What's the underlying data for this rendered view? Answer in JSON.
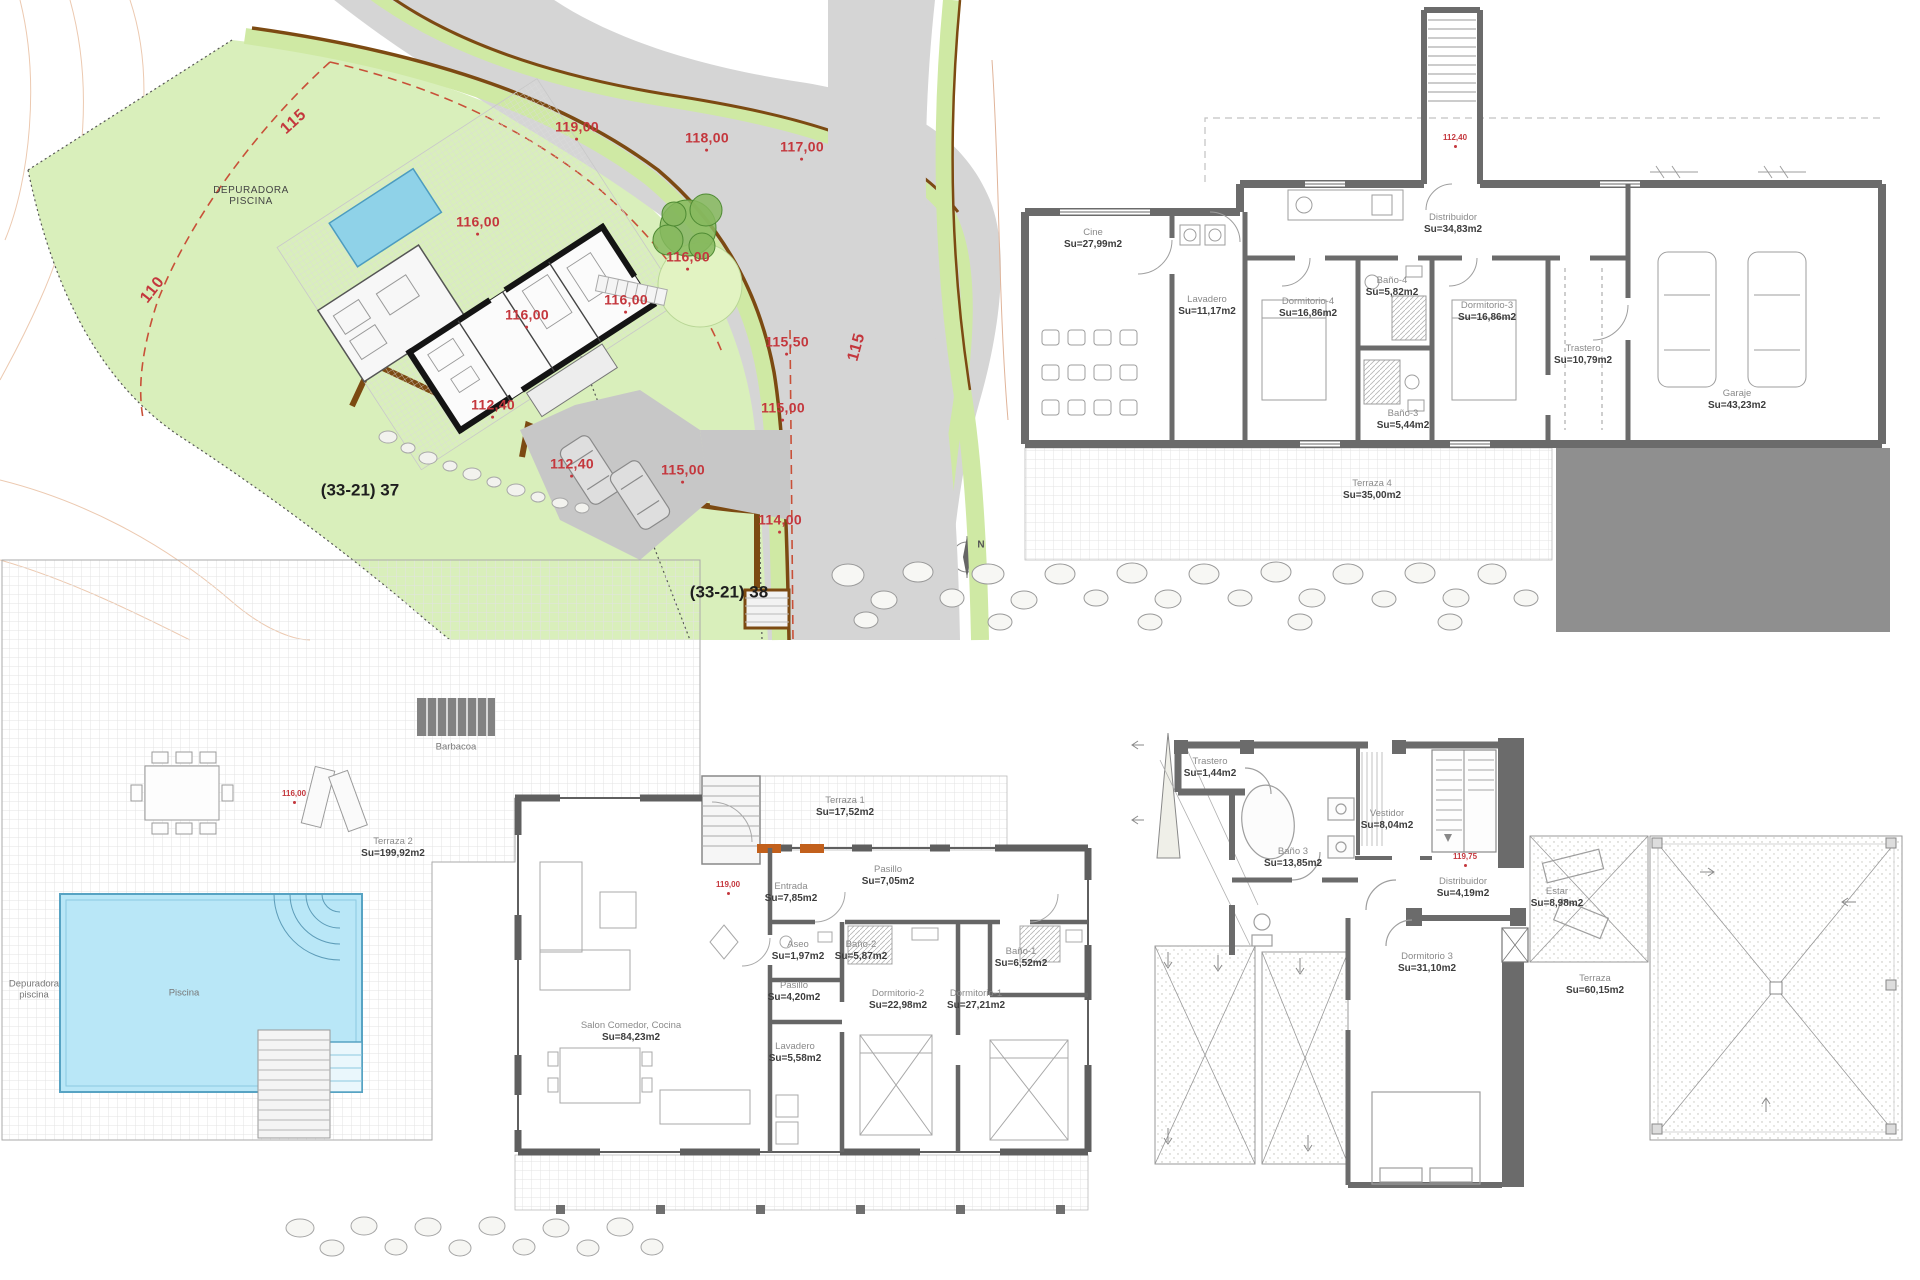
{
  "colors": {
    "elevation_red": "#c4373d",
    "plot_green": "#d9efbb",
    "road_gray": "#d5d5d5",
    "curb_brown": "#7c4a12",
    "wall_gray": "#6b6b6b",
    "pool_blue": "#b9e7f7",
    "dark_block_gray": "#8f8f8f",
    "door_orange": "#c2601c"
  },
  "plans": {
    "site_plan": {
      "labels": [
        {
          "n": "setback-label-115",
          "t": [
            "115"
          ],
          "x": 294,
          "y": 122,
          "c": "red-md",
          "r": -42
        },
        {
          "n": "setback-label-110",
          "t": [
            "110"
          ],
          "x": 153,
          "y": 290,
          "c": "red-md",
          "r": -52
        },
        {
          "n": "road-label-115",
          "t": [
            "115"
          ],
          "x": 857,
          "y": 347,
          "c": "red-md",
          "r": -75
        },
        {
          "n": "elevation",
          "t": [
            "119,00"
          ],
          "x": 577,
          "y": 130,
          "c": "red-lg",
          "d": true
        },
        {
          "n": "elevation",
          "t": [
            "118,00"
          ],
          "x": 707,
          "y": 141,
          "c": "red-lg",
          "d": true
        },
        {
          "n": "elevation",
          "t": [
            "117,00"
          ],
          "x": 802,
          "y": 150,
          "c": "red-lg",
          "d": true
        },
        {
          "n": "elevation",
          "t": [
            "116,00"
          ],
          "x": 478,
          "y": 225,
          "c": "red-lg",
          "d": true
        },
        {
          "n": "elevation",
          "t": [
            "116,00"
          ],
          "x": 527,
          "y": 318,
          "c": "red-lg",
          "d": true
        },
        {
          "n": "elevation",
          "t": [
            "116,00"
          ],
          "x": 626,
          "y": 303,
          "c": "red-lg",
          "d": true
        },
        {
          "n": "elevation",
          "t": [
            "116,00"
          ],
          "x": 688,
          "y": 260,
          "c": "red-lg",
          "d": true
        },
        {
          "n": "elevation",
          "t": [
            "115,50"
          ],
          "x": 787,
          "y": 345,
          "c": "red-lg",
          "d": true
        },
        {
          "n": "elevation",
          "t": [
            "115,00"
          ],
          "x": 783,
          "y": 411,
          "c": "red-lg",
          "d": true
        },
        {
          "n": "elevation",
          "t": [
            "115,00"
          ],
          "x": 683,
          "y": 473,
          "c": "red-lg",
          "d": true
        },
        {
          "n": "elevation",
          "t": [
            "112,40"
          ],
          "x": 493,
          "y": 408,
          "c": "red-lg",
          "d": true
        },
        {
          "n": "elevation",
          "t": [
            "112,40"
          ],
          "x": 572,
          "y": 467,
          "c": "red-lg",
          "d": true
        },
        {
          "n": "elevation",
          "t": [
            "114,00"
          ],
          "x": 780,
          "y": 523,
          "c": "red-lg",
          "d": true
        },
        {
          "n": "depuradora-piscina-label",
          "t": [
            "DEPURADORA",
            "PISCINA"
          ],
          "x": 251,
          "y": 196,
          "c": "site-name"
        },
        {
          "n": "parcel-label",
          "t": [
            "(33-21) 37"
          ],
          "x": 360,
          "y": 490,
          "c": "blk"
        },
        {
          "n": "parcel-label",
          "t": [
            "(33-21) 38"
          ],
          "x": 729,
          "y": 592,
          "c": "blk"
        },
        {
          "n": "north-label",
          "t": [
            "N"
          ],
          "x": 981,
          "y": 545,
          "c": "north"
        }
      ]
    },
    "basement_plan": {
      "labels": [
        {
          "n": "room-label",
          "t": [
            "Cine",
            "Su=27,99m2"
          ],
          "x": 1093,
          "y": 239,
          "c": "room"
        },
        {
          "n": "room-label",
          "t": [
            "Lavadero",
            "Su=11,17m2"
          ],
          "x": 1207,
          "y": 306,
          "c": "room"
        },
        {
          "n": "room-label",
          "t": [
            "Dormitorio-4",
            "Su=16,86m2"
          ],
          "x": 1308,
          "y": 308,
          "c": "room"
        },
        {
          "n": "room-label",
          "t": [
            "Baño-4",
            "Su=5,82m2"
          ],
          "x": 1392,
          "y": 287,
          "c": "room"
        },
        {
          "n": "room-label",
          "t": [
            "Dormitorio-3",
            "Su=16,86m2"
          ],
          "x": 1487,
          "y": 312,
          "c": "room"
        },
        {
          "n": "room-label",
          "t": [
            "Trastero",
            "Su=10,79m2"
          ],
          "x": 1583,
          "y": 355,
          "c": "room"
        },
        {
          "n": "room-label",
          "t": [
            "Baño-3",
            "Su=5,44m2"
          ],
          "x": 1403,
          "y": 420,
          "c": "room"
        },
        {
          "n": "room-label",
          "t": [
            "Garaje",
            "Su=43,23m2"
          ],
          "x": 1737,
          "y": 400,
          "c": "room"
        },
        {
          "n": "room-label",
          "t": [
            "Distribuidor",
            "Su=34,83m2"
          ],
          "x": 1453,
          "y": 224,
          "c": "room"
        },
        {
          "n": "room-label",
          "t": [
            "Terraza 4",
            "Su=35,00m2"
          ],
          "x": 1372,
          "y": 490,
          "c": "room"
        },
        {
          "n": "elevation",
          "t": [
            "112,40"
          ],
          "x": 1455,
          "y": 141,
          "c": "red-sm",
          "d": true
        }
      ]
    },
    "main_floor_plan": {
      "labels": [
        {
          "n": "room-label",
          "t": [
            "Terraza 2",
            "Su=199,92m2"
          ],
          "x": 393,
          "y": 848,
          "c": "room"
        },
        {
          "n": "room-label",
          "t": [
            "Barbacoa"
          ],
          "x": 456,
          "y": 748,
          "c": "room-plain"
        },
        {
          "n": "room-label",
          "t": [
            "Piscina"
          ],
          "x": 184,
          "y": 994,
          "c": "room-plain"
        },
        {
          "n": "room-label",
          "t": [
            "Depuradora",
            "piscina"
          ],
          "x": 34,
          "y": 990,
          "c": "room-plain"
        },
        {
          "n": "room-label",
          "t": [
            "Salon Comedor, Cocina",
            "Su=84,23m2"
          ],
          "x": 631,
          "y": 1032,
          "c": "room"
        },
        {
          "n": "room-label",
          "t": [
            "Entrada",
            "Su=7,85m2"
          ],
          "x": 791,
          "y": 893,
          "c": "room"
        },
        {
          "n": "room-label",
          "t": [
            "Terraza 1",
            "Su=17,52m2"
          ],
          "x": 845,
          "y": 807,
          "c": "room"
        },
        {
          "n": "room-label",
          "t": [
            "Pasillo",
            "Su=7,05m2"
          ],
          "x": 888,
          "y": 876,
          "c": "room"
        },
        {
          "n": "room-label",
          "t": [
            "Aseo",
            "Su=1,97m2"
          ],
          "x": 798,
          "y": 951,
          "c": "room"
        },
        {
          "n": "room-label",
          "t": [
            "Baño-2",
            "Su=5,87m2"
          ],
          "x": 861,
          "y": 951,
          "c": "room"
        },
        {
          "n": "room-label",
          "t": [
            "Pasillo",
            "Su=4,20m2"
          ],
          "x": 794,
          "y": 992,
          "c": "room"
        },
        {
          "n": "room-label",
          "t": [
            "Dormitorio-2",
            "Su=22,98m2"
          ],
          "x": 898,
          "y": 1000,
          "c": "room"
        },
        {
          "n": "room-label",
          "t": [
            "Dormitorio-1",
            "Su=27,21m2"
          ],
          "x": 976,
          "y": 1000,
          "c": "room"
        },
        {
          "n": "room-label",
          "t": [
            "Baño-1",
            "Su=6,52m2"
          ],
          "x": 1021,
          "y": 958,
          "c": "room"
        },
        {
          "n": "room-label",
          "t": [
            "Lavadero",
            "Su=5,58m2"
          ],
          "x": 795,
          "y": 1053,
          "c": "room"
        },
        {
          "n": "elevation",
          "t": [
            "116,00"
          ],
          "x": 294,
          "y": 797,
          "c": "red-sm",
          "d": true
        },
        {
          "n": "elevation",
          "t": [
            "119,00"
          ],
          "x": 728,
          "y": 888,
          "c": "red-sm",
          "d": true
        }
      ]
    },
    "upper_floor_plan": {
      "labels": [
        {
          "n": "room-label",
          "t": [
            "Trastero",
            "Su=1,44m2"
          ],
          "x": 1210,
          "y": 768,
          "c": "room"
        },
        {
          "n": "room-label",
          "t": [
            "Vestidor",
            "Su=8,04m2"
          ],
          "x": 1387,
          "y": 820,
          "c": "room"
        },
        {
          "n": "room-label",
          "t": [
            "Baño 3",
            "Su=13,85m2"
          ],
          "x": 1293,
          "y": 858,
          "c": "room"
        },
        {
          "n": "room-label",
          "t": [
            "Distribuidor",
            "Su=4,19m2"
          ],
          "x": 1463,
          "y": 888,
          "c": "room"
        },
        {
          "n": "room-label",
          "t": [
            "Estar",
            "Su=8,98m2"
          ],
          "x": 1557,
          "y": 898,
          "c": "room"
        },
        {
          "n": "room-label",
          "t": [
            "Dormitorio 3",
            "Su=31,10m2"
          ],
          "x": 1427,
          "y": 963,
          "c": "room"
        },
        {
          "n": "room-label",
          "t": [
            "Terraza",
            "Su=60,15m2"
          ],
          "x": 1595,
          "y": 985,
          "c": "room"
        },
        {
          "n": "elevation",
          "t": [
            "119,75"
          ],
          "x": 1465,
          "y": 860,
          "c": "red-sm",
          "d": true
        }
      ]
    }
  }
}
